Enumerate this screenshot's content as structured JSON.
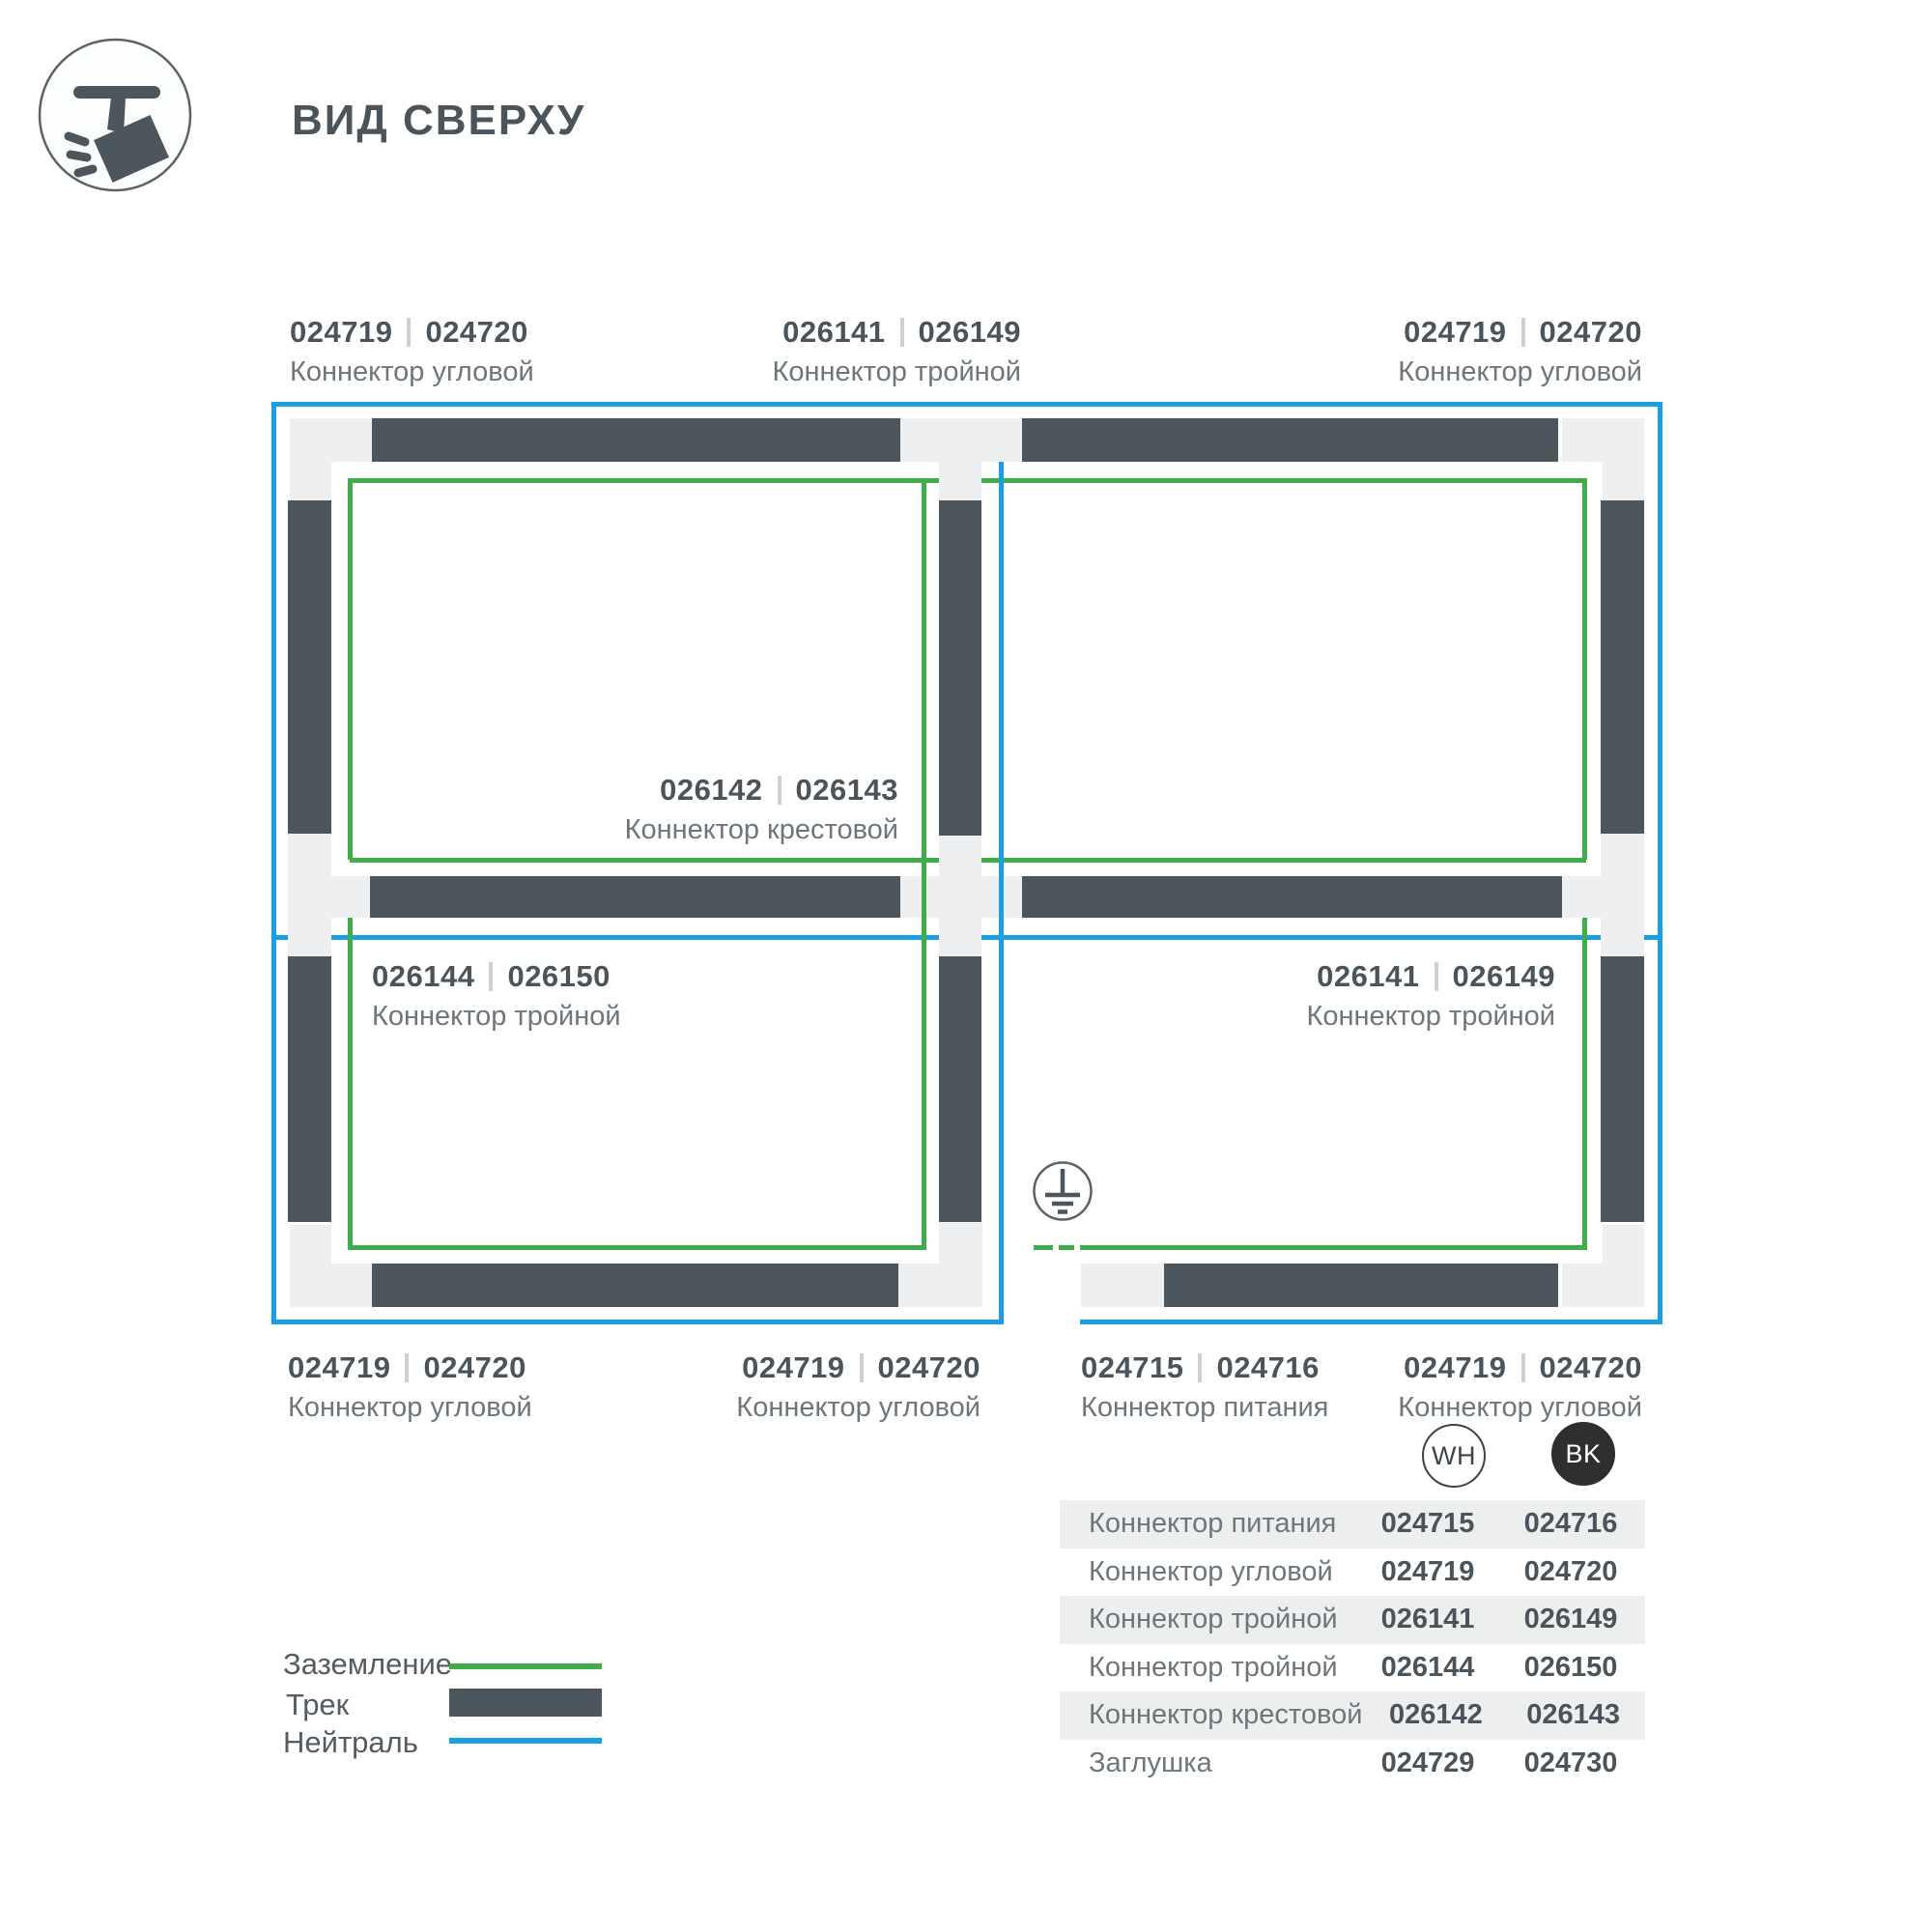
{
  "header": {
    "title": "ВИД СВЕРХУ",
    "icon": "track-spotlight-icon"
  },
  "colors": {
    "track": "#4d565c",
    "connector": "#edeff0",
    "ground_green": "#3fae49",
    "neutral_blue": "#1b9fe0",
    "text_dark": "#4b545b",
    "text_secondary": "#6d767d",
    "row_shade": "#edefef",
    "badge_black": "#2e2f2e"
  },
  "diagram": {
    "ground_symbol": "earth-ground-icon",
    "callouts": [
      {
        "num1": "024719",
        "num2": "024720",
        "name": "Коннектор угловой"
      },
      {
        "num1": "026141",
        "num2": "026149",
        "name": "Коннектор тройной"
      },
      {
        "num1": "024719",
        "num2": "024720",
        "name": "Коннектор угловой"
      },
      {
        "num1": "026142",
        "num2": "026143",
        "name": "Коннектор крестовой"
      },
      {
        "num1": "026144",
        "num2": "026150",
        "name": "Коннектор тройной"
      },
      {
        "num1": "026141",
        "num2": "026149",
        "name": "Коннектор тройной"
      },
      {
        "num1": "024719",
        "num2": "024720",
        "name": "Коннектор угловой"
      },
      {
        "num1": "024719",
        "num2": "024720",
        "name": "Коннектор угловой"
      },
      {
        "num1": "024715",
        "num2": "024716",
        "name": "Коннектор питания"
      },
      {
        "num1": "024719",
        "num2": "024720",
        "name": "Коннектор угловой"
      }
    ]
  },
  "legend": {
    "items": [
      {
        "label": "Заземление",
        "swatch": "green-line"
      },
      {
        "label": "Трек",
        "swatch": "dark-bar"
      },
      {
        "label": "Нейтраль",
        "swatch": "blue-line"
      }
    ]
  },
  "table": {
    "badge_wh": "WH",
    "badge_bk": "BK",
    "rows": [
      {
        "name": "Коннектор питания",
        "wh": "024715",
        "bk": "024716"
      },
      {
        "name": "Коннектор угловой",
        "wh": "024719",
        "bk": "024720"
      },
      {
        "name": "Коннектор тройной",
        "wh": "026141",
        "bk": "026149"
      },
      {
        "name": "Коннектор тройной",
        "wh": "026144",
        "bk": "026150"
      },
      {
        "name": "Коннектор крестовой",
        "wh": "026142",
        "bk": "026143"
      },
      {
        "name": "Заглушка",
        "wh": "024729",
        "bk": "024730"
      }
    ]
  }
}
